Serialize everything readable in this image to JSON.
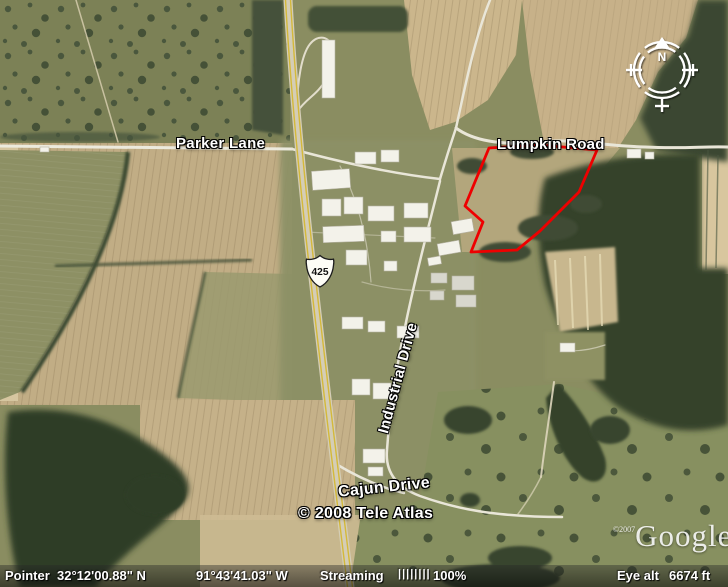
{
  "map": {
    "labels": {
      "parker_lane": "Parker Lane",
      "lumpkin_road": "Lumpkin Road",
      "industrial_drive": "Industrial Drive",
      "cajun_drive": "Cajun Drive",
      "route_shield": "425",
      "tele_atlas_credit": "© 2008 Tele Atlas",
      "google_copyright": "©2007",
      "google_wordmark": "Google",
      "google_tm": "™",
      "compass_north": "N"
    },
    "parcel": {
      "color": "#ee0000"
    }
  },
  "status_bar": {
    "pointer_label": "Pointer",
    "latitude": "32°12'00.88\" N",
    "longitude": "91°43'41.03\" W",
    "streaming_label": "Streaming",
    "streaming_bars": "||||||||",
    "streaming_percent": "100%",
    "eye_alt_label": "Eye alt",
    "eye_alt_value": "6674 ft"
  }
}
